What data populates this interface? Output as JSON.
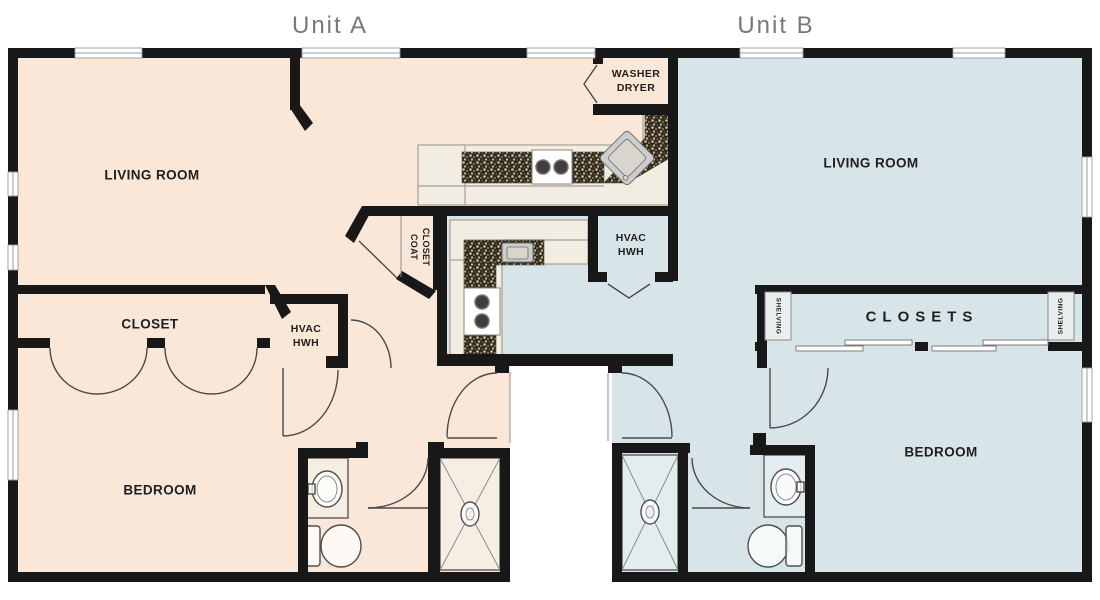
{
  "titles": {
    "unit_a": "Unit A",
    "unit_b": "Unit B"
  },
  "unit_a": {
    "living_room": "LIVING ROOM",
    "closet": "CLOSET",
    "bedroom": "BEDROOM",
    "hvac": {
      "line1": "HVAC",
      "line2": "HWH"
    },
    "coat_closet": {
      "line1": "COAT",
      "line2": "CLOSET"
    },
    "washer_dryer": {
      "line1": "WASHER",
      "line2": "DRYER"
    }
  },
  "unit_b": {
    "living_room": "LIVING ROOM",
    "closets": "CLOSETS",
    "bedroom": "BEDROOM",
    "hvac": {
      "line1": "HVAC",
      "line2": "HWH"
    },
    "shelving_left": "SHELVING",
    "shelving_right": "SHELVING"
  },
  "colors": {
    "unit_a_fill": "#FAE7D8",
    "unit_b_fill": "#D8E5E8",
    "wall": "#181818",
    "title_text": "#76787A",
    "label_text": "#1F1F1F",
    "counter_fill": "#F2EDE2",
    "counter_stroke": "#99917F",
    "granite_dark": "#322B20",
    "granite_light": "#CBBFA3",
    "appliance_fill": "#FFFFFF",
    "sink_fill": "#C9CFD0",
    "fixture_stroke": "#4F4F4F",
    "door_arc": "#4A4A4A",
    "window_line": "#9B9B9B",
    "shelf_fill": "#EBEEEF",
    "shower_a_fill": "#F6EEE2",
    "shower_b_fill": "#E3ECEE"
  }
}
